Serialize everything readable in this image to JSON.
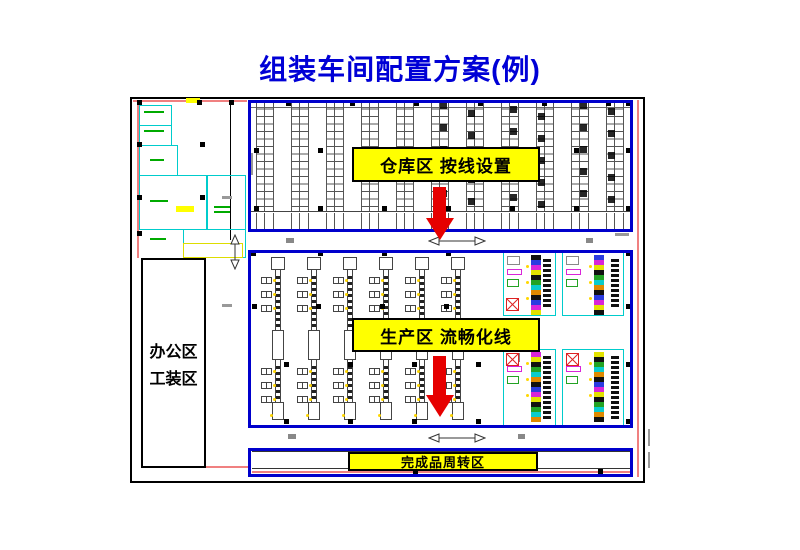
{
  "title": {
    "text": "组装车间配置方案(例)"
  },
  "labels": {
    "warehouse": "仓库区 按线设置",
    "production": "生产区 流畅化线",
    "finished": "完成品周转区",
    "office_line1": "办公区",
    "office_line2": "工装区"
  },
  "colors": {
    "title_blue": "#0000D6",
    "box_blue": "#0000CC",
    "label_yellow": "#FFFF00",
    "arrow_red": "#E60000",
    "cad_cyan": "#00CCCC",
    "cad_pink": "#F08080",
    "cad_green": "#00AA00"
  },
  "plan": {
    "warehouse": {
      "racks_x": [
        256,
        291,
        326,
        361,
        396,
        431,
        466,
        501,
        536,
        571,
        606
      ],
      "rack_top": 101,
      "rack_h": 110,
      "stub_top": 213,
      "stub_h": 17,
      "dark": {
        "5": [
          8,
          0
        ],
        "6": [
          1,
          8
        ],
        "7": [
          8,
          4
        ],
        "8": [
          1,
          11
        ],
        "9": [
          8,
          0
        ],
        "10": [
          1,
          6
        ]
      }
    },
    "production": {
      "line_x": [
        278,
        314,
        350,
        386,
        422,
        458
      ],
      "line_top": 258,
      "line_bottom": 420,
      "station_ys": [
        277,
        291,
        305,
        368,
        382,
        396
      ],
      "blocks": [
        [
          503,
          252,
          53,
          64
        ],
        [
          562,
          252,
          62,
          64
        ],
        [
          503,
          349,
          53,
          77
        ],
        [
          562,
          349,
          62,
          77
        ]
      ],
      "block_palette": [
        "#111111",
        "#2B3BE0",
        "#D925D9",
        "#E3E300",
        "#111111",
        "#23A323",
        "#0ACCCC",
        "#E08A00"
      ],
      "xbox": [
        [
          0,
          3,
          46
        ],
        [
          2,
          3,
          4
        ],
        [
          3,
          4,
          4
        ]
      ]
    },
    "squares": [
      [
        137,
        100
      ],
      [
        197,
        100
      ],
      [
        229,
        100
      ],
      [
        137,
        142
      ],
      [
        200,
        142
      ],
      [
        137,
        195
      ],
      [
        200,
        195
      ],
      [
        137,
        231
      ],
      [
        286,
        101
      ],
      [
        350,
        101
      ],
      [
        414,
        101
      ],
      [
        478,
        101
      ],
      [
        542,
        101
      ],
      [
        606,
        101
      ],
      [
        626,
        101
      ],
      [
        254,
        148
      ],
      [
        318,
        148
      ],
      [
        382,
        148
      ],
      [
        446,
        148
      ],
      [
        510,
        148
      ],
      [
        574,
        148
      ],
      [
        626,
        148
      ],
      [
        254,
        206
      ],
      [
        318,
        206
      ],
      [
        382,
        206
      ],
      [
        446,
        206
      ],
      [
        510,
        206
      ],
      [
        574,
        206
      ],
      [
        626,
        206
      ],
      [
        251,
        251
      ],
      [
        318,
        251
      ],
      [
        382,
        251
      ],
      [
        446,
        251
      ],
      [
        626,
        251
      ],
      [
        252,
        304
      ],
      [
        316,
        304
      ],
      [
        380,
        304
      ],
      [
        444,
        304
      ],
      [
        626,
        304
      ],
      [
        284,
        362
      ],
      [
        348,
        362
      ],
      [
        412,
        362
      ],
      [
        476,
        362
      ],
      [
        626,
        362
      ],
      [
        284,
        419
      ],
      [
        348,
        419
      ],
      [
        412,
        419
      ],
      [
        476,
        419
      ],
      [
        626,
        419
      ],
      [
        413,
        469
      ],
      [
        598,
        469
      ]
    ],
    "deco": [
      [
        133,
        100,
        114,
        2,
        "#F08080"
      ],
      [
        137,
        102,
        2,
        156,
        "#F08080"
      ],
      [
        637,
        100,
        2,
        377,
        "#F08080"
      ],
      [
        206,
        466,
        42,
        2,
        "#F08080"
      ],
      [
        252,
        471,
        378,
        1.5,
        "#F08080"
      ],
      [
        230,
        100,
        1,
        140,
        "#000000"
      ],
      [
        251,
        107,
        380,
        1,
        "#666666"
      ],
      [
        251,
        211,
        380,
        1,
        "#444444"
      ],
      [
        252,
        451,
        378,
        1,
        "#333333"
      ],
      [
        252,
        468,
        378,
        1,
        "#333333"
      ],
      [
        250,
        153,
        3,
        22,
        "#999999"
      ],
      [
        222,
        196,
        10,
        3,
        "#999999"
      ],
      [
        222,
        304,
        10,
        3,
        "#999999"
      ],
      [
        286,
        238,
        8,
        5,
        "#888888"
      ],
      [
        586,
        238,
        7,
        5,
        "#888888"
      ],
      [
        288,
        434,
        8,
        5,
        "#888888"
      ],
      [
        518,
        434,
        7,
        5,
        "#888888"
      ],
      [
        615,
        233,
        14,
        3,
        "#999999"
      ],
      [
        648,
        429,
        2,
        17,
        "#999999"
      ],
      [
        648,
        452,
        2,
        16,
        "#999999"
      ],
      [
        144,
        111,
        20,
        2,
        "#00AA00"
      ],
      [
        144,
        130,
        20,
        2,
        "#00AA00"
      ],
      [
        150,
        159,
        14,
        2,
        "#00AA00"
      ],
      [
        150,
        200,
        18,
        2,
        "#00AA00"
      ],
      [
        214,
        206,
        16,
        2,
        "#00AA00"
      ],
      [
        214,
        211,
        16,
        2,
        "#00AA00"
      ],
      [
        150,
        238,
        16,
        2,
        "#00AA00"
      ],
      [
        186,
        98,
        14,
        5,
        "#FFFF00"
      ],
      [
        176,
        206,
        18,
        6,
        "#FFFF00"
      ]
    ],
    "outlines": [
      [
        139,
        105,
        33,
        21,
        "#00CCCC"
      ],
      [
        139,
        125,
        33,
        21,
        "#00CCCC"
      ],
      [
        139,
        145,
        39,
        31,
        "#00CCCC"
      ],
      [
        139,
        175,
        68,
        55,
        "#00CCCC"
      ],
      [
        183,
        229,
        63,
        29,
        "#00CCCC"
      ],
      [
        207,
        175,
        39,
        55,
        "#00CCCC"
      ],
      [
        183,
        243,
        60,
        15,
        "#DDDD00"
      ]
    ]
  }
}
